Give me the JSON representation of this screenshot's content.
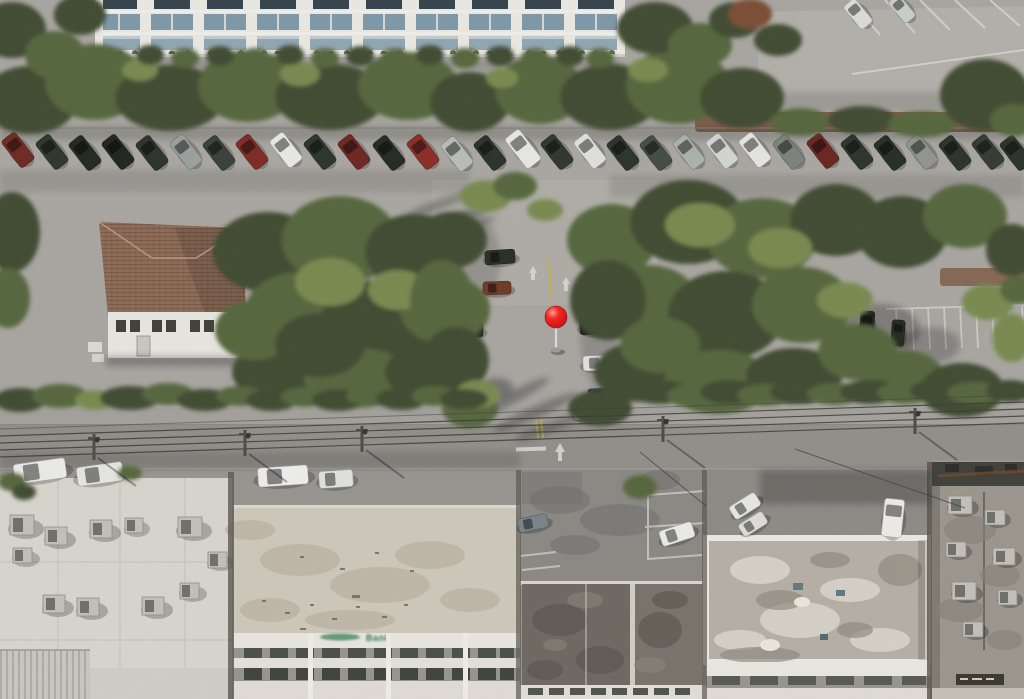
{
  "scene": {
    "type": "aerial-imagery",
    "view": "oblique-satellite-photo",
    "description": "Oblique aerial photo of an urban block: white condo building with blue glass windows and a long row of angle-parked cars along the top street; a tiled-roof house and tree-covered parking lot in the middle with a red location pin; a road with power lines and utility poles; commercial flat rooftops with HVAC units and a bank building across the bottom.",
    "marker": {
      "x": 556,
      "y": 317,
      "color": "#e8100f",
      "label": "location-pin"
    }
  },
  "palette": {
    "pavement": "#a8a5a0",
    "road": "#918e89",
    "tree-dark": "#3f4c31",
    "tree-mid": "#55663c",
    "tree-light": "#78894f",
    "roof-tile": "#8d6a55",
    "building-white": "#e9e7e1",
    "roof-white": "#d7d4cc",
    "roof-dark": "#6e6861",
    "roof-tan": "#cdc7ba",
    "roof-gray": "#9b958c",
    "window-blue": "#7d98a8",
    "hedge": "#47523a",
    "mulch": "#7d5843",
    "line-white": "#d9d7d2",
    "line-yellow": "#c7b14b",
    "wire": "#3c3c37",
    "sign-green": "#2f7a50",
    "pin-red": "#e8100f"
  },
  "signage": {
    "bank_sign": {
      "label": "Bank",
      "color": "#2f7a50"
    }
  },
  "vehicles": [
    {
      "x": 18,
      "y": 150,
      "w": 17,
      "h": 34,
      "a": -38,
      "c": "#6f2a24"
    },
    {
      "x": 52,
      "y": 152,
      "w": 17,
      "h": 34,
      "a": -38,
      "c": "#2e372c"
    },
    {
      "x": 85,
      "y": 153,
      "w": 17,
      "h": 34,
      "a": -38,
      "c": "#23291f"
    },
    {
      "x": 118,
      "y": 152,
      "w": 17,
      "h": 34,
      "a": -38,
      "c": "#20261e"
    },
    {
      "x": 152,
      "y": 153,
      "w": 17,
      "h": 34,
      "a": -38,
      "c": "#2b332a"
    },
    {
      "x": 186,
      "y": 152,
      "w": 17,
      "h": 34,
      "a": -38,
      "c": "#9aa09e"
    },
    {
      "x": 219,
      "y": 153,
      "w": 17,
      "h": 34,
      "a": -38,
      "c": "#39413a"
    },
    {
      "x": 252,
      "y": 152,
      "w": 17,
      "h": 34,
      "a": -38,
      "c": "#7e2b24"
    },
    {
      "x": 286,
      "y": 150,
      "w": 17,
      "h": 34,
      "a": -38,
      "c": "#e7e7e3"
    },
    {
      "x": 320,
      "y": 152,
      "w": 17,
      "h": 34,
      "a": -38,
      "c": "#2c352b"
    },
    {
      "x": 354,
      "y": 152,
      "w": 17,
      "h": 34,
      "a": -38,
      "c": "#6f2722"
    },
    {
      "x": 389,
      "y": 153,
      "w": 17,
      "h": 34,
      "a": -38,
      "c": "#242b22"
    },
    {
      "x": 423,
      "y": 152,
      "w": 17,
      "h": 34,
      "a": -38,
      "c": "#8a2e26"
    },
    {
      "x": 457,
      "y": 154,
      "w": 17,
      "h": 34,
      "a": -38,
      "c": "#b8bcb8"
    },
    {
      "x": 490,
      "y": 153,
      "w": 17,
      "h": 34,
      "a": -38,
      "c": "#2a322a"
    },
    {
      "x": 523,
      "y": 149,
      "w": 18,
      "h": 38,
      "a": -38,
      "c": "#e6e6e2"
    },
    {
      "x": 557,
      "y": 152,
      "w": 17,
      "h": 34,
      "a": -38,
      "c": "#30382e"
    },
    {
      "x": 590,
      "y": 151,
      "w": 17,
      "h": 34,
      "a": -38,
      "c": "#dededa"
    },
    {
      "x": 623,
      "y": 153,
      "w": 17,
      "h": 34,
      "a": -38,
      "c": "#2b342b"
    },
    {
      "x": 656,
      "y": 153,
      "w": 17,
      "h": 34,
      "a": -38,
      "c": "#444c43"
    },
    {
      "x": 689,
      "y": 152,
      "w": 17,
      "h": 34,
      "a": -38,
      "c": "#aab0ac"
    },
    {
      "x": 722,
      "y": 151,
      "w": 17,
      "h": 34,
      "a": -38,
      "c": "#d2d4d0"
    },
    {
      "x": 755,
      "y": 150,
      "w": 17,
      "h": 34,
      "a": -38,
      "c": "#e4e4e0"
    },
    {
      "x": 789,
      "y": 152,
      "w": 17,
      "h": 34,
      "a": -38,
      "c": "#7b837b"
    },
    {
      "x": 823,
      "y": 151,
      "w": 17,
      "h": 34,
      "a": -38,
      "c": "#6b2621"
    },
    {
      "x": 857,
      "y": 152,
      "w": 17,
      "h": 34,
      "a": -38,
      "c": "#2c342b"
    },
    {
      "x": 890,
      "y": 153,
      "w": 17,
      "h": 34,
      "a": -38,
      "c": "#262e25"
    },
    {
      "x": 922,
      "y": 152,
      "w": 17,
      "h": 34,
      "a": -38,
      "c": "#8f958e"
    },
    {
      "x": 955,
      "y": 153,
      "w": 17,
      "h": 34,
      "a": -38,
      "c": "#2b332a"
    },
    {
      "x": 988,
      "y": 152,
      "w": 17,
      "h": 34,
      "a": -38,
      "c": "#333b31"
    },
    {
      "x": 1016,
      "y": 153,
      "w": 17,
      "h": 34,
      "a": -38,
      "c": "#2a322a"
    },
    {
      "x": 537,
      "y": 80,
      "w": 13,
      "h": 26,
      "a": 8,
      "c": "#5e2a24"
    },
    {
      "x": 563,
      "y": 83,
      "w": 13,
      "h": 24,
      "a": 4,
      "c": "#dcdcd8"
    },
    {
      "x": 858,
      "y": 14,
      "w": 15,
      "h": 30,
      "a": -40,
      "c": "#d9dbd8"
    },
    {
      "x": 902,
      "y": 9,
      "w": 14,
      "h": 28,
      "a": -40,
      "c": "#c9cdc9"
    },
    {
      "x": 500,
      "y": 257,
      "w": 30,
      "h": 14,
      "a": -4,
      "c": "#2a2e26"
    },
    {
      "x": 497,
      "y": 288,
      "w": 28,
      "h": 13,
      "a": -2,
      "c": "#6e3a28"
    },
    {
      "x": 468,
      "y": 330,
      "w": 30,
      "h": 14,
      "a": 0,
      "c": "#23281f"
    },
    {
      "x": 597,
      "y": 326,
      "w": 34,
      "h": 16,
      "a": -3,
      "c": "#1d231c"
    },
    {
      "x": 604,
      "y": 301,
      "w": 30,
      "h": 14,
      "a": -2,
      "c": "#2a2f28"
    },
    {
      "x": 600,
      "y": 363,
      "w": 34,
      "h": 15,
      "a": -2,
      "c": "#dfdfdb"
    },
    {
      "x": 603,
      "y": 396,
      "w": 30,
      "h": 15,
      "a": -2,
      "c": "#2e3a55"
    },
    {
      "x": 587,
      "y": 413,
      "w": 26,
      "h": 13,
      "a": -2,
      "c": "#d9d9d5"
    },
    {
      "x": 533,
      "y": 523,
      "w": 30,
      "h": 14,
      "a": -12,
      "c": "#7a838a"
    },
    {
      "x": 677,
      "y": 534,
      "w": 34,
      "h": 16,
      "a": -18,
      "c": "#e9e9e5"
    },
    {
      "x": 745,
      "y": 506,
      "w": 30,
      "h": 15,
      "a": -32,
      "c": "#e6e6e2"
    },
    {
      "x": 753,
      "y": 524,
      "w": 28,
      "h": 14,
      "a": -32,
      "c": "#dcdcd8"
    },
    {
      "x": 893,
      "y": 518,
      "w": 20,
      "h": 38,
      "a": 6,
      "c": "#eceae6"
    },
    {
      "x": 40,
      "y": 471,
      "w": 52,
      "h": 20,
      "a": -8,
      "c": "#e9e9e5"
    },
    {
      "x": 100,
      "y": 474,
      "w": 46,
      "h": 19,
      "a": -8,
      "c": "#e4e4e0"
    },
    {
      "x": 283,
      "y": 476,
      "w": 50,
      "h": 19,
      "a": -4,
      "c": "#ececea"
    },
    {
      "x": 336,
      "y": 479,
      "w": 34,
      "h": 17,
      "a": -4,
      "c": "#dfdfdb"
    },
    {
      "x": 867,
      "y": 325,
      "w": 14,
      "h": 28,
      "a": 4,
      "c": "#20261e"
    },
    {
      "x": 898,
      "y": 333,
      "w": 13,
      "h": 26,
      "a": 4,
      "c": "#252b22"
    }
  ],
  "poles": [
    {
      "x": 94,
      "y": 434
    },
    {
      "x": 245,
      "y": 430
    },
    {
      "x": 362,
      "y": 426
    },
    {
      "x": 663,
      "y": 416
    },
    {
      "x": 915,
      "y": 408
    }
  ]
}
